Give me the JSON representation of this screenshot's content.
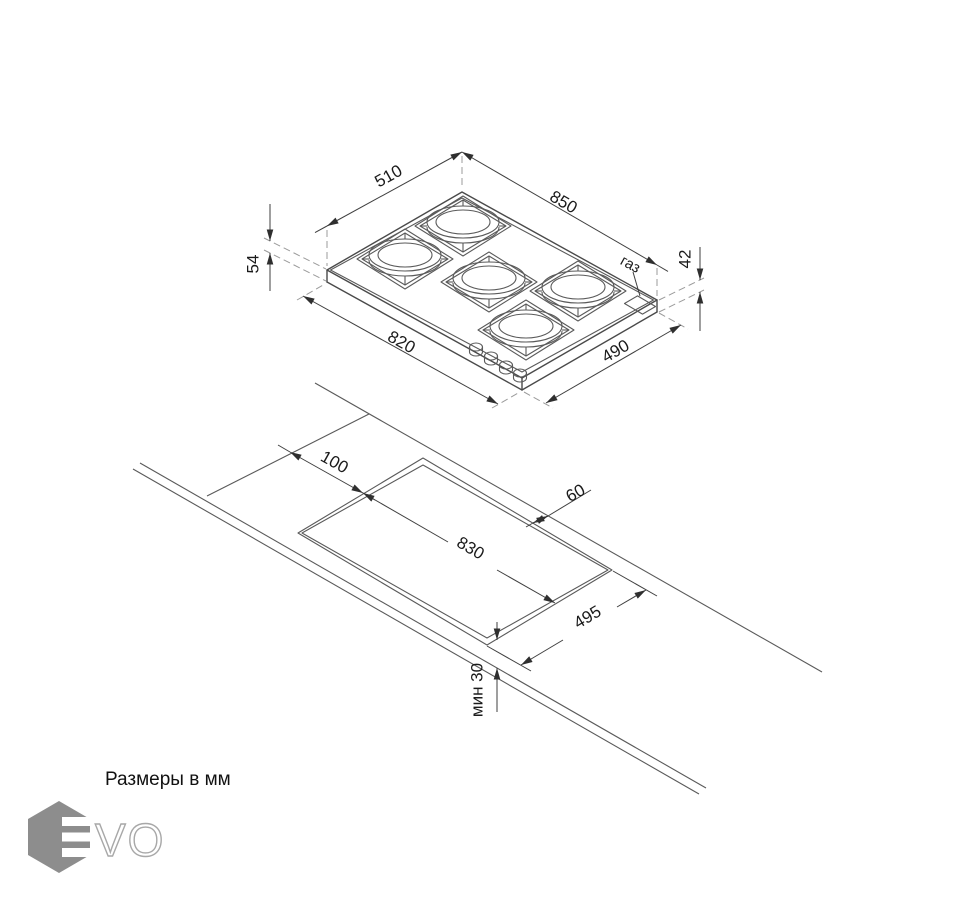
{
  "units_note": "Размеры в мм",
  "hob_view": {
    "dim_top_width": "850",
    "dim_top_depth": "510",
    "dim_height_with_grids": "54",
    "dim_body_height": "42",
    "dim_bottom_width": "820",
    "dim_bottom_depth": "490",
    "gas_connection_label": "газ"
  },
  "cutout_view": {
    "dim_end_offset": "100",
    "dim_back_offset": "60",
    "dim_cutout_length": "830",
    "dim_cutout_width": "495",
    "dim_min_front_clearance": "мин 30"
  },
  "logo": {
    "outline_letters": "VO"
  },
  "colors": {
    "drawing_line": "#4a4a4a",
    "logo_gray": "#8d8d8d"
  }
}
